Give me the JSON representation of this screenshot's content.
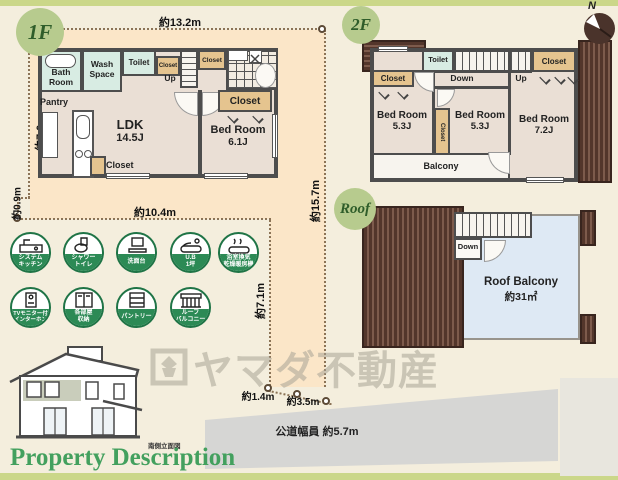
{
  "page": {
    "accent_green": "#2c8a55",
    "bar_color": "#cbd789",
    "land_color": "#fbe6c8",
    "wall_color": "#4d4d4d",
    "roof_color": "#53362b"
  },
  "compass": {
    "label": "N"
  },
  "floor1": {
    "badge": "1F",
    "dims": {
      "top": "約13.2m",
      "left": "約7.0m",
      "left_lower": "約0.9m",
      "bottom": "約10.4m",
      "right": "約15.7m",
      "inner": "約7.1m",
      "bottom_a": "約1.4m",
      "bottom_b": "約3.5m"
    },
    "rooms": {
      "bath1": "Bath",
      "bath2": "Room",
      "wash1": "Wash",
      "wash2": "Space",
      "toilet": "Toilet",
      "up": "Up",
      "pantry": "Pantry",
      "ldk": "LDK",
      "ldk_size": "14.5J",
      "bed": "Bed Room",
      "bed_size": "6.1J"
    }
  },
  "floor2": {
    "badge": "2F",
    "rooms": {
      "toilet": "Toilet",
      "down": "Down",
      "up": "Up",
      "bed1": "Bed Room",
      "bed1_size": "5.3J",
      "bed2": "Bed Room",
      "bed2_size": "5.3J",
      "bed3": "Bed Room",
      "bed3_size": "7.2J",
      "balcony": "Balcony"
    }
  },
  "roof": {
    "badge": "Roof",
    "down": "Down",
    "balcony": "Roof Balcony",
    "area": "約31㎡"
  },
  "common": {
    "closet": "Closet"
  },
  "amenities": [
    {
      "name": "system-kitchen",
      "line1": "システム",
      "line2": "キッチン"
    },
    {
      "name": "shower-toilet",
      "line1": "シャワー",
      "line2": "トイレ"
    },
    {
      "name": "washstand",
      "line1": "洗面台",
      "line2": ""
    },
    {
      "name": "unit-bath",
      "line1": "U.B",
      "line2": "1坪"
    },
    {
      "name": "bath-dryer",
      "line1": "浴室換気",
      "line2": "乾燥暖房機"
    },
    {
      "name": "tv-intercom",
      "line1": "TVモニター付",
      "line2": "インターホン"
    },
    {
      "name": "room-storage",
      "line1": "各部屋",
      "line2": "収納"
    },
    {
      "name": "pantry",
      "line1": "パントリー",
      "line2": ""
    },
    {
      "name": "roof-balcony",
      "line1": "ルーフ",
      "line2": "バルコニー"
    }
  ],
  "site": {
    "road_label": "公道幅員 約5.7m",
    "elevation_caption": "南側立面図"
  },
  "watermark": {
    "text": "ヤマダ不動産"
  },
  "footer": {
    "title": "Property Description"
  }
}
